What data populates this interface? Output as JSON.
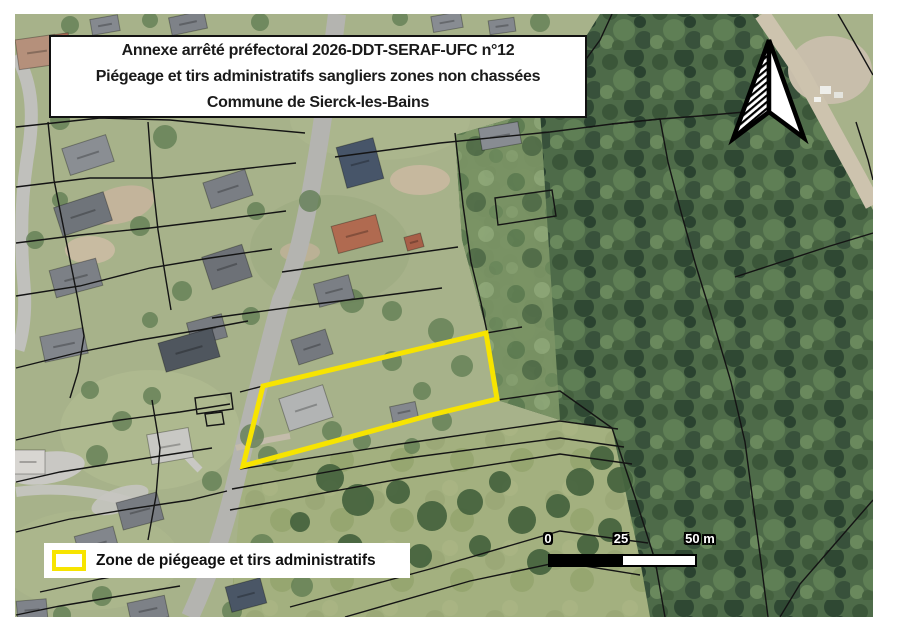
{
  "title_box": {
    "line1": "Annexe arrêté préfectoral 2026-DDT-SERAF-UFC n°12",
    "line2": "Piégeage et tirs administratifs sangliers zones non chassées",
    "line3": "Commune de Sierck-les-Bains"
  },
  "legend": {
    "label": "Zone de piégeage et tirs administratifs",
    "zone_color": "#f7e400"
  },
  "scale_bar": {
    "ticks": [
      "0",
      "25",
      "50 m"
    ]
  },
  "map": {
    "type": "aerial-cadastral-map",
    "icons": {
      "north_arrow": "north-arrow"
    },
    "colors": {
      "zone_outline": "#f7e400",
      "parcel_line": "#141414",
      "forest": "#4e6b49",
      "meadow": "#a3b07f",
      "road": "#b4b4b0"
    }
  }
}
